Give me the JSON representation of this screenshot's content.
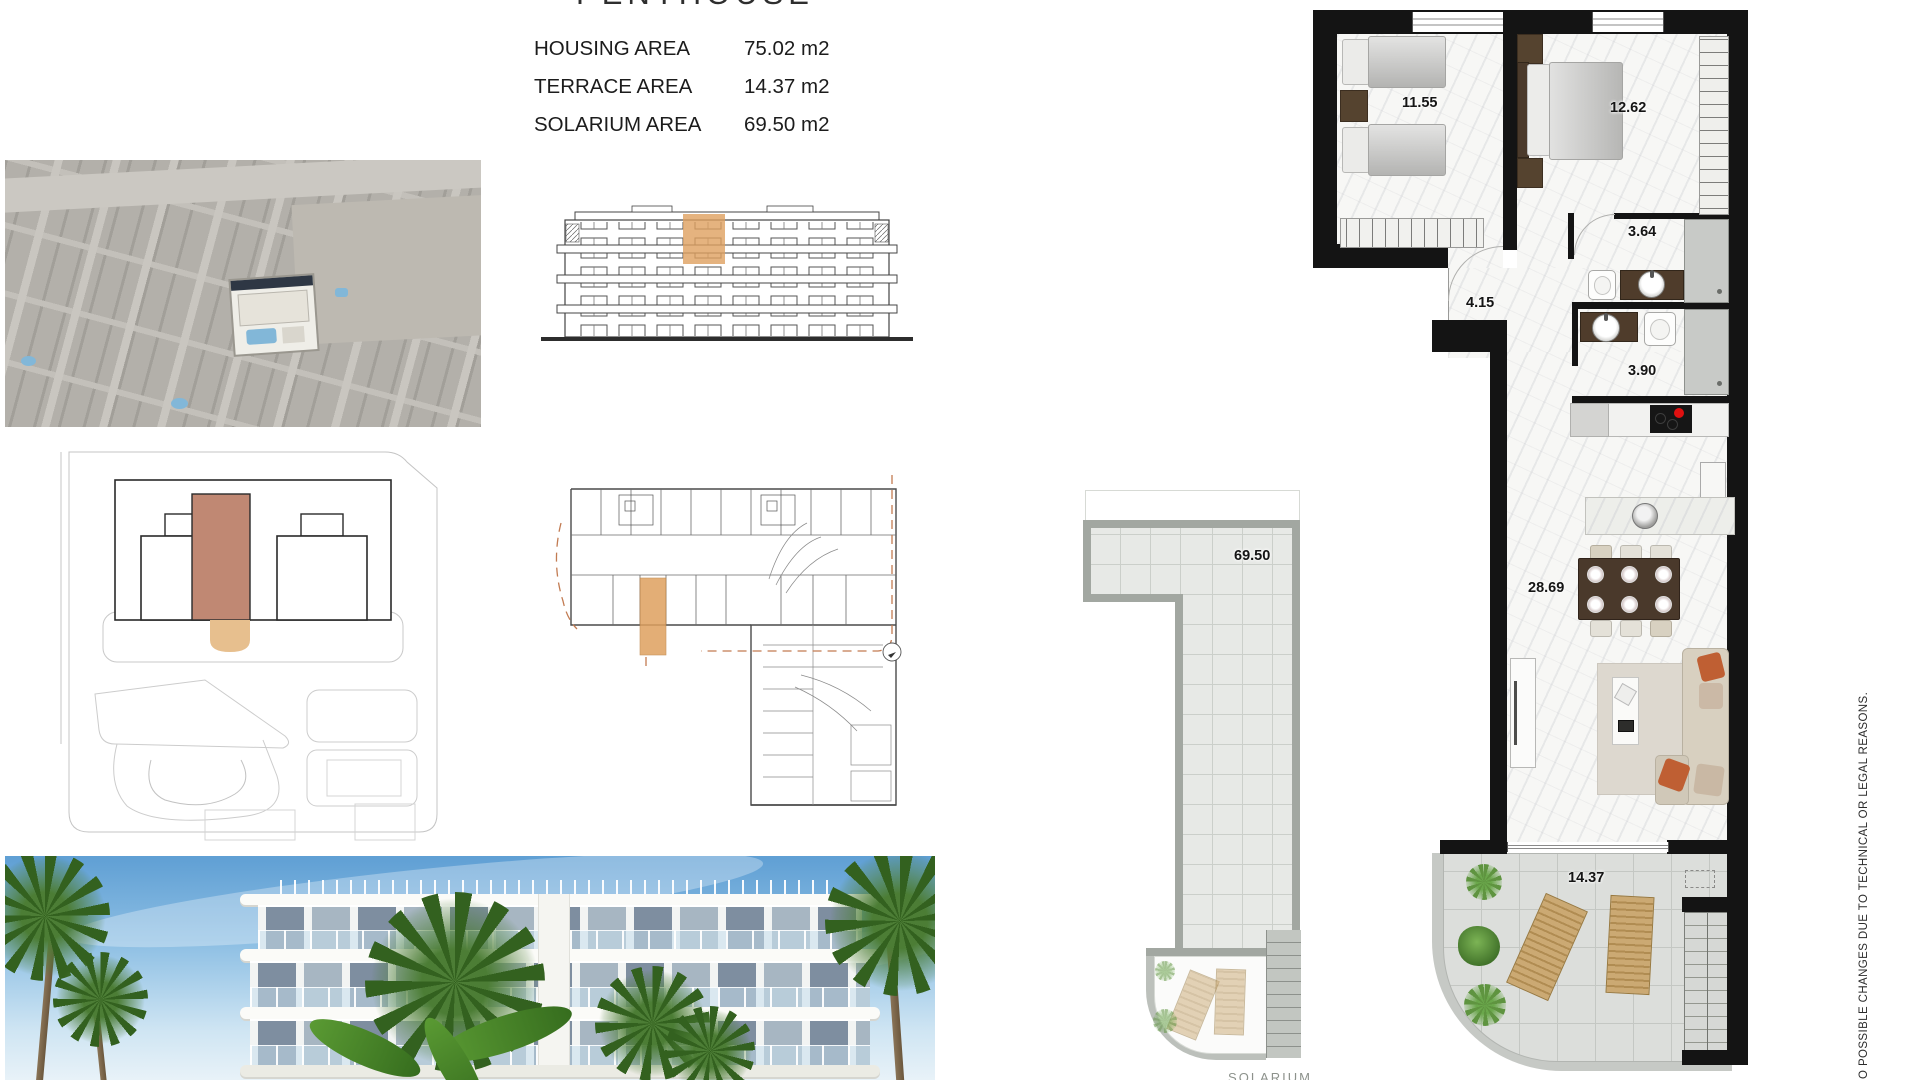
{
  "header": {
    "title": "PENTHOUSE",
    "areas": [
      {
        "label": "HOUSING AREA",
        "value": "75.02 m2"
      },
      {
        "label": "TERRACE AREA",
        "value": "14.37 m2"
      },
      {
        "label": "SOLARIUM AREA",
        "value": "69.50 m2"
      }
    ]
  },
  "plan": {
    "rooms": {
      "twin_bedroom": "11.55",
      "master_bedroom": "12.62",
      "bathroom_1": "3.64",
      "hallway": "4.15",
      "bathroom_2": "3.90",
      "living": "28.69",
      "terrace": "14.37"
    }
  },
  "solarium": {
    "area": "69.50",
    "caption": "SOLARIUM"
  },
  "disclaimer": "O POSSIBLE CHANGES DUE TO TECHNICAL OR LEGAL REASONS.",
  "colors": {
    "highlight_orange": "#DFA05F",
    "highlight_salmon": "#C08873",
    "highlight_tan": "#E7BF8E",
    "wall_black": "#141414",
    "burner_red": "#E01010",
    "pool_blue": "#82B7D8",
    "solarium_gray": "#A2A7A1",
    "sky_blue": "#5F9FD4",
    "palm_green": "#3F6F2D"
  }
}
